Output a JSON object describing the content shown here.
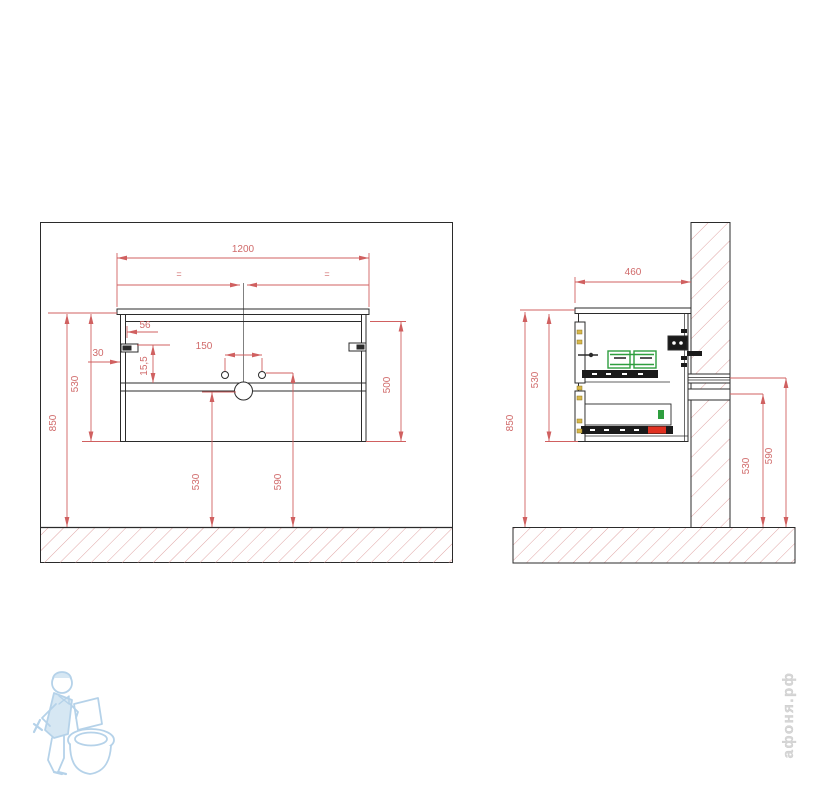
{
  "page": {
    "background": "#ffffff",
    "description_note": "technical installation drawing of wall-hung vanity cabinet, front and side views"
  },
  "colors": {
    "outline": "#2b2b2b",
    "dimension": "#d06060",
    "dimension_text": "#d06a6a",
    "hatch": "#e0a4a4",
    "hardware_green": "#2e9e3e",
    "hardware_red": "#e03020",
    "hardware_yellow": "#d8b84a",
    "watermark_blue": "#a9cbe6",
    "watermark_gray": "#d6d6d6"
  },
  "front_view": {
    "name": "front view",
    "dims": {
      "width": "1200",
      "equal_left": "=",
      "equal_right": "=",
      "hinge_offset": "56",
      "wall_offset": "30",
      "faucet_spacing": "150",
      "bracket_drop": "15,5",
      "height_cabinet": "530",
      "height_top": "850",
      "height_body": "500",
      "height_drain": "530",
      "height_faucet": "590"
    }
  },
  "side_view": {
    "name": "side view",
    "dims": {
      "depth": "460",
      "height_cabinet": "530",
      "height_top": "850",
      "height_outlet_low": "530",
      "height_outlet_high": "590"
    }
  },
  "watermark": {
    "brand_text": "афоня.рф",
    "logo": "plumber-with-toilet"
  }
}
